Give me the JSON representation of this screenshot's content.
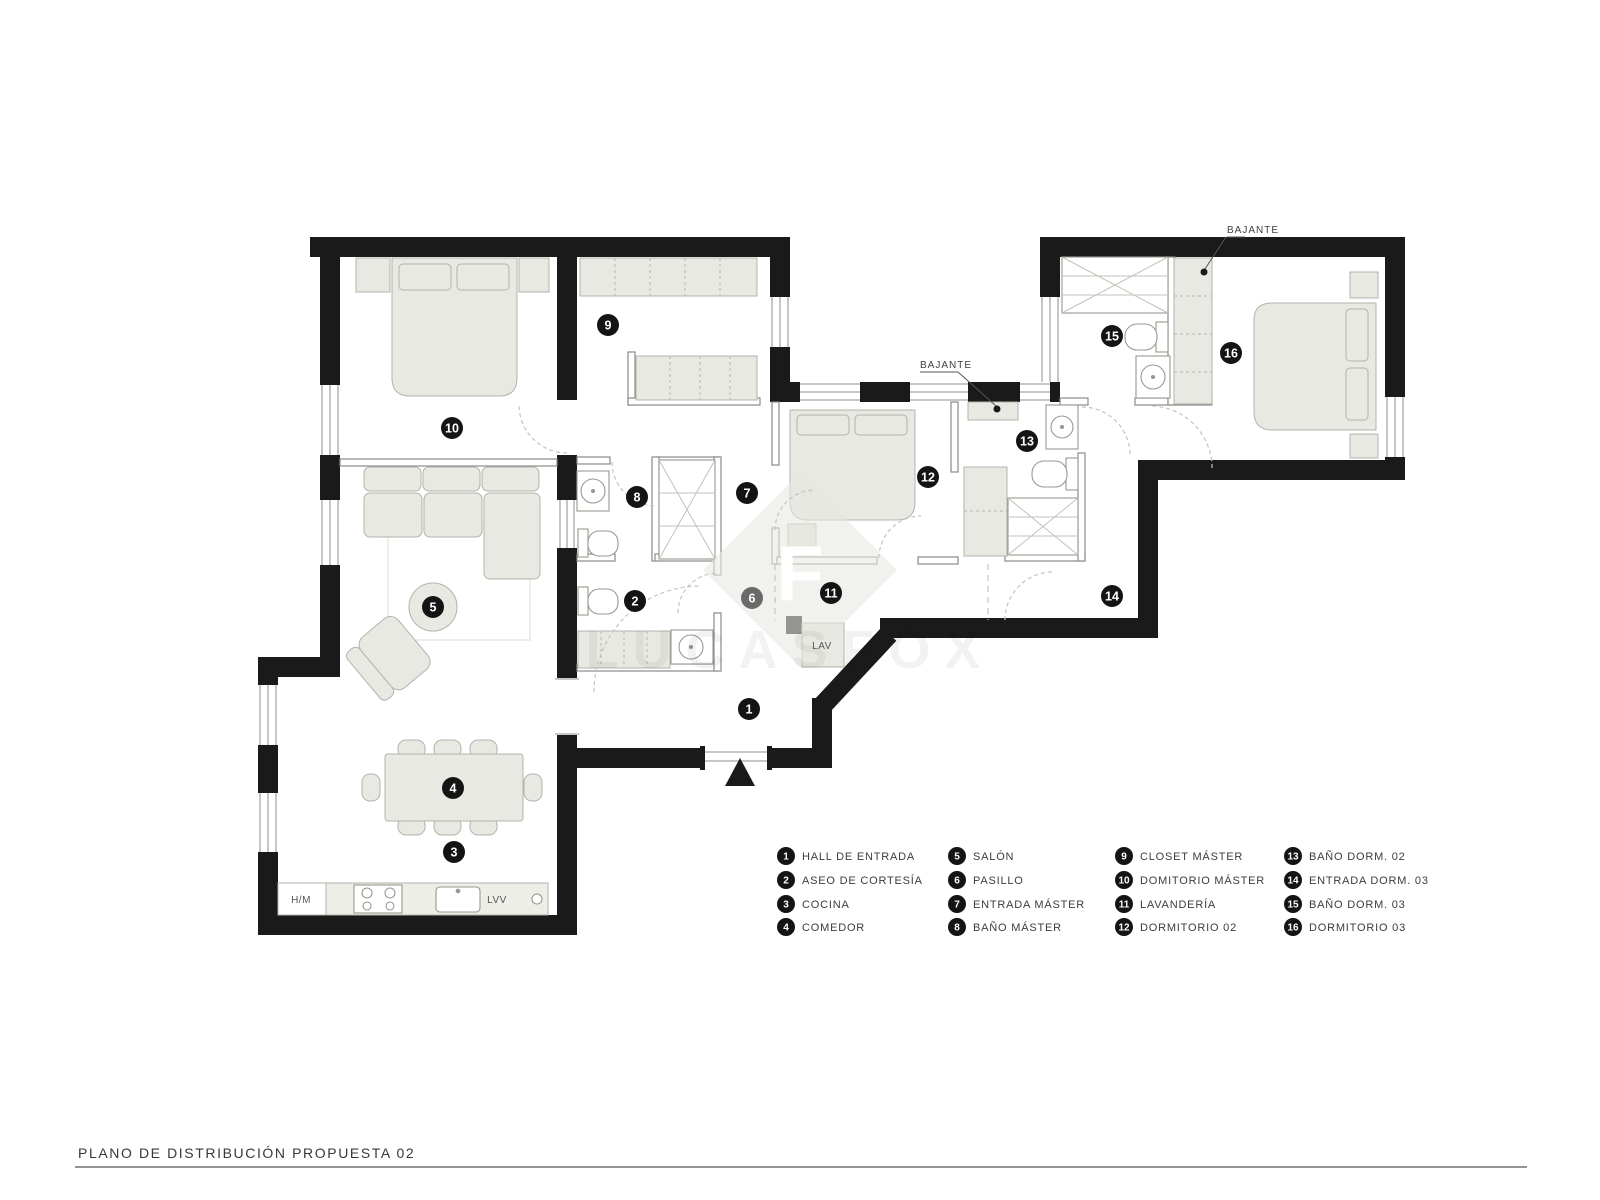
{
  "page": {
    "title": "PLANO DE DISTRIBUCIÓN PROPUESTA 02"
  },
  "watermark": {
    "letter": "F",
    "brand": "LUCASFOX"
  },
  "annotations": {
    "bajante_mid": "BAJANTE",
    "bajante_right": "BAJANTE",
    "lav": "LAV",
    "hm": "H/M",
    "lvv": "LVV"
  },
  "badges": {
    "r1": "1",
    "r2": "2",
    "r3": "3",
    "r4": "4",
    "r5": "5",
    "r6": "6",
    "r7": "7",
    "r8": "8",
    "r9": "9",
    "r10": "10",
    "r11": "11",
    "r12": "12",
    "r13": "13",
    "r14": "14",
    "r15": "15",
    "r16": "16"
  },
  "legend": [
    {
      "num": "1",
      "label": "HALL DE ENTRADA"
    },
    {
      "num": "2",
      "label": "ASEO DE CORTESÍA"
    },
    {
      "num": "3",
      "label": "COCINA"
    },
    {
      "num": "4",
      "label": "COMEDOR"
    },
    {
      "num": "5",
      "label": "SALÓN"
    },
    {
      "num": "6",
      "label": "PASILLO"
    },
    {
      "num": "7",
      "label": "ENTRADA MÁSTER"
    },
    {
      "num": "8",
      "label": "BAÑO MÁSTER"
    },
    {
      "num": "9",
      "label": "CLOSET MÁSTER"
    },
    {
      "num": "10",
      "label": "DOMITORIO MÁSTER"
    },
    {
      "num": "11",
      "label": "LAVANDERÍA"
    },
    {
      "num": "12",
      "label": "DORMITORIO 02"
    },
    {
      "num": "13",
      "label": "BAÑO DORM. 02"
    },
    {
      "num": "14",
      "label": "ENTRADA DORM. 03"
    },
    {
      "num": "15",
      "label": "BAÑO DORM. 03"
    },
    {
      "num": "16",
      "label": "DORMITORIO 03"
    }
  ],
  "colors": {
    "wall": "#1a1a1a",
    "furniture_fill": "#e9e9e3",
    "furniture_stroke": "#b3b3ab",
    "badge": "#141414",
    "badge_muted": "#6a6a6a"
  }
}
